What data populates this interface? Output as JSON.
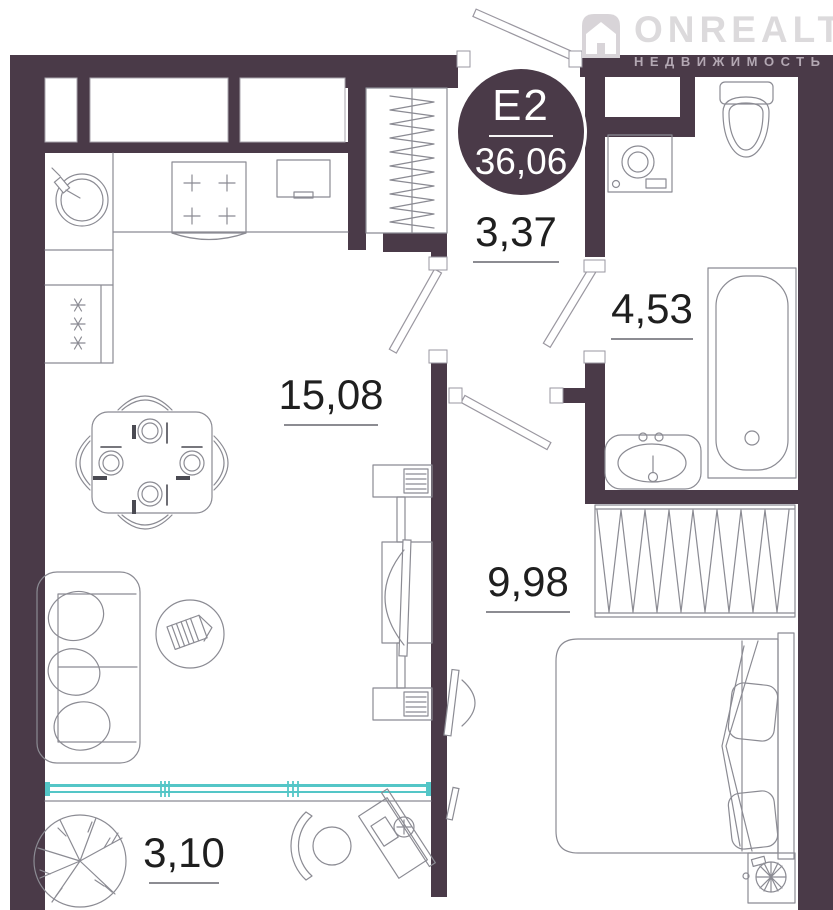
{
  "logo": {
    "brand": "ONREALT",
    "tagline": "НЕДВИЖИМОСТЬ",
    "icon": "house-icon"
  },
  "badge": {
    "plan_code": "Е2",
    "total_area": "36,06"
  },
  "rooms": {
    "hallway": {
      "area": "3,37"
    },
    "bathroom": {
      "area": "4,53"
    },
    "living_kitchen": {
      "area": "15,08"
    },
    "bedroom": {
      "area": "9,98"
    },
    "balcony": {
      "area": "3,10"
    }
  },
  "colors": {
    "wall": "#4a3a48",
    "glazing": "#54c6c7",
    "furniture_line": "#8b8b93",
    "label_text": "#1f1f1f",
    "badge_text": "#ffffff",
    "logo_brand": "#dcdadc",
    "logo_tagline": "#b3a8b3"
  }
}
